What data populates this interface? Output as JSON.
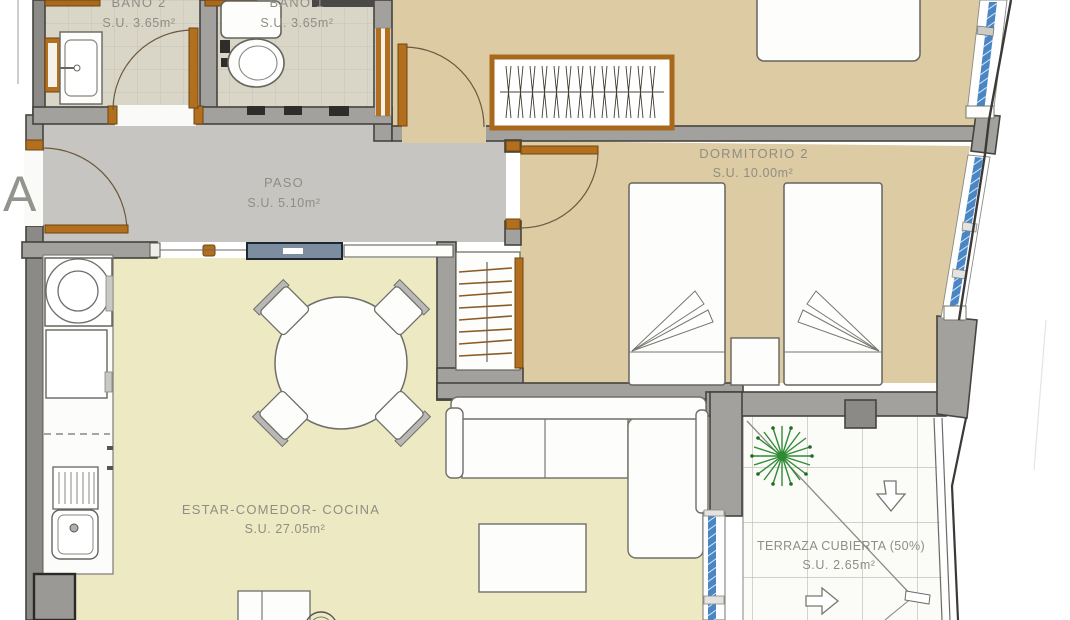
{
  "plan": {
    "block_label": "A",
    "rooms": {
      "bano2": {
        "name": "BAÑO 2",
        "area": "S.U. 3.65m²"
      },
      "bano1": {
        "name": "BAÑO 1",
        "area": "S.U. 3.65m²"
      },
      "paso": {
        "name": "PASO",
        "area": "S.U. 5.10m²"
      },
      "dormitorio2": {
        "name": "DORMITORIO 2",
        "area": "S.U. 10.00m²"
      },
      "estar": {
        "name": "ESTAR-COMEDOR- COCINA",
        "area": "S.U. 27.05m²"
      },
      "terraza": {
        "name": "TERRAZA CUBIERTA (50%)",
        "area": "S.U. 2.65m²"
      }
    },
    "colors": {
      "wall": "#a2a19e",
      "floor_bedroom": "#ddcba3",
      "floor_living": "#ede9c2",
      "floor_hall": "#c7c5c1",
      "floor_bath": "#d9d5c7",
      "floor_terrace": "#fbfbf8",
      "wood": "#b26f1e",
      "glazing": "#4a86c4"
    }
  }
}
